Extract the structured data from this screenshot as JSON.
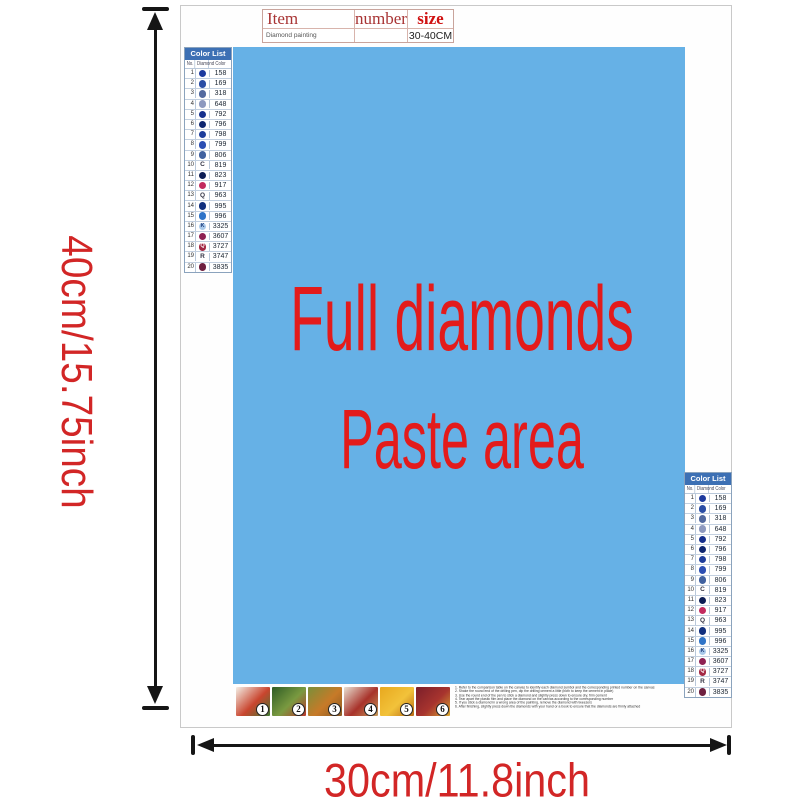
{
  "product_label": {
    "table": {
      "col_item": "Item",
      "col_number": "number",
      "col_size": "size",
      "item_value": "Diamond painting",
      "number_value": "",
      "size_value": "30-40CM"
    }
  },
  "paste_area": {
    "line1": "Full diamonds",
    "line2": "Paste area",
    "bg_color": "#66b1e6",
    "text_color": "#e31b1b"
  },
  "dimensions": {
    "height_label": "40cm/15.75inch",
    "width_label": "30cm/11.8inch",
    "label_color": "#d22626",
    "arrow_color": "#151515"
  },
  "color_list": {
    "title": "Color List",
    "header_bg": "#3d70b4",
    "columns": [
      "No.",
      "Diamond",
      "Color"
    ],
    "rows": [
      {
        "no": "1",
        "code": "158",
        "circle": "#1d3a9e",
        "letter": "",
        "letter_color": "#ffffff"
      },
      {
        "no": "2",
        "code": "169",
        "circle": "#2a4da5",
        "letter": "",
        "letter_color": "#ffffff"
      },
      {
        "no": "3",
        "code": "318",
        "circle": "#52699f",
        "letter": "",
        "letter_color": "#ffffff"
      },
      {
        "no": "4",
        "code": "648",
        "circle": "#8d99bf",
        "letter": "",
        "letter_color": "#ffffff"
      },
      {
        "no": "5",
        "code": "792",
        "circle": "#152f8d",
        "letter": "",
        "letter_color": "#ffffff"
      },
      {
        "no": "6",
        "code": "796",
        "circle": "#0e2670",
        "letter": "",
        "letter_color": "#ffffff"
      },
      {
        "no": "7",
        "code": "798",
        "circle": "#1e3d9b",
        "letter": "",
        "letter_color": "#ffffff"
      },
      {
        "no": "8",
        "code": "799",
        "circle": "#2c4fb3",
        "letter": "",
        "letter_color": "#ffffff"
      },
      {
        "no": "9",
        "code": "806",
        "circle": "#40619f",
        "letter": "",
        "letter_color": "#ffffff"
      },
      {
        "no": "10",
        "code": "819",
        "circle": "",
        "letter": "C",
        "letter_color": "#334455"
      },
      {
        "no": "11",
        "code": "823",
        "circle": "#0c1d55",
        "letter": "",
        "letter_color": "#ffffff"
      },
      {
        "no": "12",
        "code": "917",
        "circle": "#c22a5e",
        "letter": "",
        "letter_color": "#ffffff"
      },
      {
        "no": "13",
        "code": "963",
        "circle": "",
        "letter": "Q",
        "letter_color": "#334455"
      },
      {
        "no": "14",
        "code": "995",
        "circle": "#11307f",
        "letter": "",
        "letter_color": "#ffffff"
      },
      {
        "no": "15",
        "code": "996",
        "circle": "#2f74c8",
        "letter": "",
        "letter_color": "#ffffff"
      },
      {
        "no": "16",
        "code": "3325",
        "circle": "#a9c9ea",
        "letter": "K",
        "letter_color": "#1a3a7a"
      },
      {
        "no": "17",
        "code": "3607",
        "circle": "#8e2153",
        "letter": "",
        "letter_color": "#ffffff"
      },
      {
        "no": "18",
        "code": "3727",
        "circle": "#a32845",
        "letter": "Q",
        "letter_color": "#ffffff"
      },
      {
        "no": "19",
        "code": "3747",
        "circle": "",
        "letter": "R",
        "letter_color": "#334455"
      },
      {
        "no": "20",
        "code": "3835",
        "circle": "#6e2040",
        "letter": "",
        "letter_color": "#ffffff"
      }
    ]
  },
  "steps": [
    {
      "label": "1",
      "colors": [
        "#f3efe6",
        "#c9452e",
        "#3f7a33"
      ]
    },
    {
      "label": "2",
      "colors": [
        "#2e5c25",
        "#7a9a40",
        "#b8372c"
      ]
    },
    {
      "label": "3",
      "colors": [
        "#7a8f3a",
        "#c77a28",
        "#8a5a24"
      ]
    },
    {
      "label": "4",
      "colors": [
        "#e8e0d2",
        "#a8322a",
        "#c49a5a"
      ]
    },
    {
      "label": "5",
      "colors": [
        "#e8a81e",
        "#f2c23a",
        "#b86a14"
      ]
    },
    {
      "label": "6",
      "colors": [
        "#7a1e2a",
        "#a8342e",
        "#d8a832"
      ]
    }
  ],
  "instructions": [
    "1. Refer to the comparison table on the canvas to identify each diamond symbol and the corresponding printed number on the canvas",
    "2. Shake the round end of the drilling pen, dip the drilling cement a little (both to keep the cement in place)",
    "3. Use the round end of the pen to stick a diamond and slightly press down to ensure dry, firm cement",
    "4. Tear apart the plastic film and place the diamond on the canvas according to the corresponding number",
    "5. If you stick a diamond in a wrong area of the painting, remove the diamond with tweezers",
    "6. After finishing, slightly press down the diamonds with your hand or a book to ensure that the diamonds are firmly attached"
  ]
}
